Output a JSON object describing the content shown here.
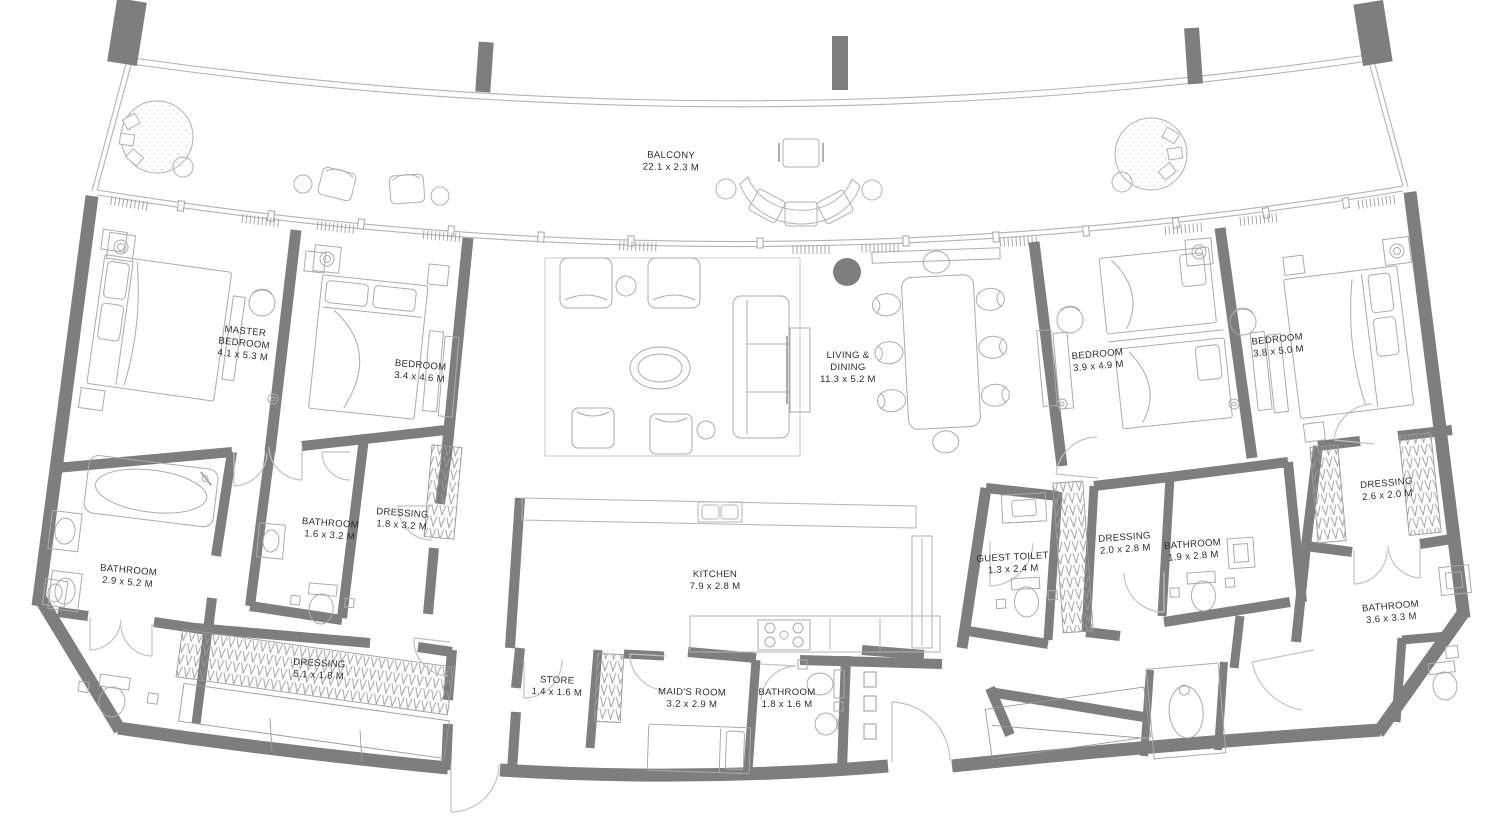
{
  "plan_type": "apartment-floor-plan",
  "colors": {
    "wall": "#7e7e7e",
    "thin_line": "#b3b3b3",
    "furniture_line": "#ababab",
    "door_line": "#c2c2c2",
    "hatch": "#9b9b9b",
    "text": "#2e2e2e",
    "background": "#ffffff"
  },
  "rooms": {
    "balcony": {
      "l1": "BALCONY",
      "l2": "22.1 x 2.3 M"
    },
    "master_bedroom": {
      "l1": "MASTER",
      "l2": "BEDROOM",
      "l3": "4.1 x 5.3 M"
    },
    "bedroom_2": {
      "l1": "BEDROOM",
      "l2": "3.4 x 4.6 M"
    },
    "living_dining": {
      "l1": "LIVING &",
      "l2": "DINING",
      "l3": "11.3 x 5.2 M"
    },
    "bedroom_3": {
      "l1": "BEDROOM",
      "l2": "3.9 x 4.9 M"
    },
    "bedroom_4": {
      "l1": "BEDROOM",
      "l2": "3.8 x 5.0 M"
    },
    "bathroom_master": {
      "l1": "BATHROOM",
      "l2": "2.9 x 5.2 M"
    },
    "bathroom_2": {
      "l1": "BATHROOM",
      "l2": "1.6 x 3.2 M"
    },
    "dressing_2": {
      "l1": "DRESSING",
      "l2": "1.8 x 3.2 M"
    },
    "dressing_master": {
      "l1": "DRESSING",
      "l2": "5.1 x 1.8 M"
    },
    "store": {
      "l1": "STORE",
      "l2": "1.4 x 1.6 M"
    },
    "kitchen": {
      "l1": "KITCHEN",
      "l2": "7.9 x 2.8 M"
    },
    "maids_room": {
      "l1": "MAID'S ROOM",
      "l2": "3.2 x 2.9 M"
    },
    "bathroom_maid": {
      "l1": "BATHROOM",
      "l2": "1.8 x 1.6 M"
    },
    "guest_toilet": {
      "l1": "GUEST TOILET",
      "l2": "1.3 x 2.4 M"
    },
    "dressing_3": {
      "l1": "DRESSING",
      "l2": "2.0 x 2.8 M"
    },
    "bathroom_3": {
      "l1": "BATHROOM",
      "l2": "1.9 x 2.8 M"
    },
    "dressing_4": {
      "l1": "DRESSING",
      "l2": "2.6 x 2.0 M"
    },
    "bathroom_4": {
      "l1": "BATHROOM",
      "l2": "3.6 x 3.3 M"
    }
  }
}
